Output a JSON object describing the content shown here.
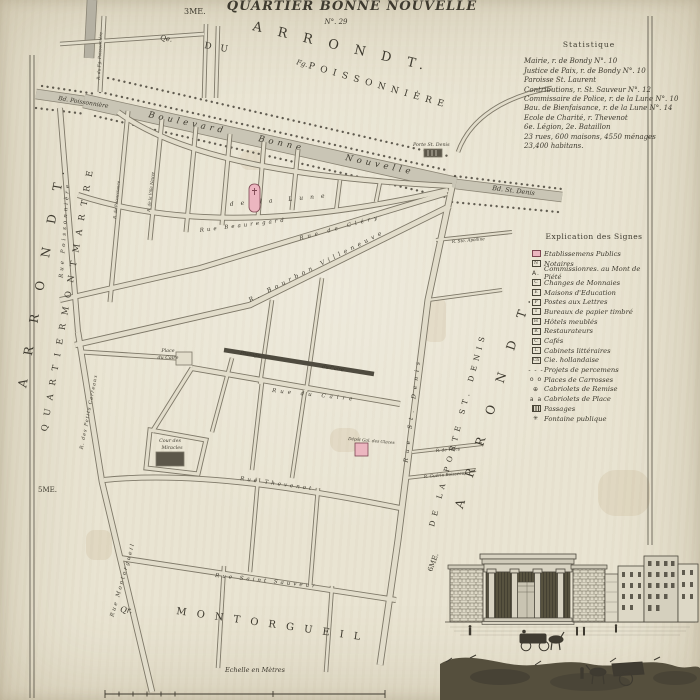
{
  "palette": {
    "paper": "#e9e4d2",
    "ink": "#3e3a2f",
    "street_edge": "#7e7868",
    "street_fill": "#e2ddcb",
    "band_fill": "#c9c5b5",
    "band_edge": "#8a8474",
    "dark_band": "#4f4b3f",
    "pink": "#ecb6c0",
    "pink_edge": "#7c4550",
    "building_dark": "#5c574a"
  },
  "statistics": {
    "title": "Statistique",
    "lines": [
      "Mairie, r. de Bondy N°. 10",
      "Justice de Paix, r. de Bondy N°. 10",
      "Paroisse St. Laurent",
      "Contributions, r. St. Sauveur N°. 12",
      "Commissaire de Police, r. de la Lune N°. 10",
      "Bau. de Bienfaisance, r. de la Lune N°. 14",
      "Ecole de Charité, r. Thevenot",
      "6e. Légion, 2e. Bataillon",
      "23 rues, 600 maisons, 4550 ménages",
      "23,400 habitans."
    ]
  },
  "legend": {
    "title": "Explication des Signes",
    "items": [
      {
        "kind": "pink",
        "sym": "",
        "label": "Etablissemens Publics"
      },
      {
        "kind": "box",
        "sym": "N",
        "label": "Notaires"
      },
      {
        "kind": "plain",
        "sym": "A.",
        "label": "Commissionres. au Mont de Piété"
      },
      {
        "kind": "box",
        "sym": "C",
        "label": "Changes de Monnaies"
      },
      {
        "kind": "box",
        "sym": "E",
        "label": "Maisons d'Education"
      },
      {
        "kind": "box",
        "sym": "P",
        "label": "Postes aux Lettres"
      },
      {
        "kind": "box",
        "sym": "T",
        "label": "Bureaux de papier timbré"
      },
      {
        "kind": "box",
        "sym": "H",
        "label": "Hôtels meublés"
      },
      {
        "kind": "box",
        "sym": "R",
        "label": "Restaurateurs"
      },
      {
        "kind": "box",
        "sym": "C",
        "label": "Cafés"
      },
      {
        "kind": "box",
        "sym": "L",
        "label": "Cabinets littéraires"
      },
      {
        "kind": "box",
        "sym": "Ch",
        "label": "Cie. hollandaise"
      },
      {
        "kind": "dash",
        "sym": "- - -",
        "label": "Projets de percemens"
      },
      {
        "kind": "plain",
        "sym": "o o",
        "label": "Places de Carrosses"
      },
      {
        "kind": "plain",
        "sym": "⊕",
        "label": "Cabriolets de Remise"
      },
      {
        "kind": "plain",
        "sym": "a a",
        "label": "Cabriolets de Place"
      },
      {
        "kind": "hatch",
        "sym": "",
        "label": "Passages"
      },
      {
        "kind": "plain",
        "sym": "✳",
        "label": "Fontaine publique"
      }
    ]
  },
  "map": {
    "neatlines": [
      "M30,55 L30,698",
      "M34,55 L34,698",
      "M648,16 L648,545",
      "M652,16 L652,545"
    ],
    "bands": [
      {
        "d": "M84,101 L456,184",
        "w": 13
      },
      {
        "d": "M456,184 L562,197",
        "w": 9
      },
      {
        "d": "M36,94 L84,101",
        "w": 9
      },
      {
        "d": "M92,0 L89,58",
        "w": 9,
        "f": "#b5b1a3"
      }
    ],
    "dark_bands": [
      {
        "d": "M224,350 L374,374",
        "w": 4.5
      }
    ],
    "dots": [
      "M108,78 L448,156",
      "M100,92 L446,170",
      "M95,116 L450,198",
      "M455,176 L562,189",
      "M452,202 L558,212",
      "M42,86 L96,94",
      "M36,108 L86,114"
    ],
    "streets": [
      {
        "d": "M118,112 C190,165 330,180 452,186",
        "w": 6
      },
      {
        "d": "M78,195 C200,235 340,215 448,190",
        "w": 6
      },
      {
        "d": "M60,300 L200,268 L447,193",
        "w": 6
      },
      {
        "d": "M75,345 L250,305 L450,206",
        "w": 6.5
      },
      {
        "d": "M452,187 L428,300 L398,540 L380,665",
        "w": 7
      },
      {
        "d": "M60,108 L78,332",
        "w": 6
      },
      {
        "d": "M78,332 L102,482 L152,692",
        "w": 6.5
      },
      {
        "d": "M104,480 C200,470 320,492 400,508",
        "w": 6
      },
      {
        "d": "M120,558 L396,600",
        "w": 6
      },
      {
        "d": "M192,368 L400,404",
        "w": 6
      },
      {
        "d": "M128,111 L110,302",
        "w": 5
      },
      {
        "d": "M162,119 L150,240",
        "w": 5
      },
      {
        "d": "M196,127 L186,232",
        "w": 5
      },
      {
        "d": "M230,134 L222,225",
        "w": 5
      },
      {
        "d": "M264,142 L258,218",
        "w": 5
      },
      {
        "d": "M298,149 L292,210",
        "w": 5
      },
      {
        "d": "M340,180 L336,212",
        "w": 4.5
      },
      {
        "d": "M380,182 L376,202",
        "w": 4.5
      },
      {
        "d": "M82,352 L176,358",
        "w": 5
      },
      {
        "d": "M232,358 L212,432",
        "w": 4.5
      },
      {
        "d": "M192,368 L152,432",
        "w": 5
      },
      {
        "d": "M150,430 L206,440 L198,474 L146,468 Z",
        "w": 5
      },
      {
        "d": "M322,278 L306,392",
        "w": 4.5
      },
      {
        "d": "M272,300 L260,384",
        "w": 4.5
      },
      {
        "d": "M262,382 L252,470",
        "w": 4.5
      },
      {
        "d": "M305,390 L292,478",
        "w": 4.5
      },
      {
        "d": "M258,478 L250,572",
        "w": 4.5
      },
      {
        "d": "M318,488 L310,588",
        "w": 4.5
      },
      {
        "d": "M224,566 L218,668",
        "w": 4.5
      },
      {
        "d": "M332,586 L326,672",
        "w": 4.5
      },
      {
        "d": "M412,452 L482,444",
        "w": 4
      },
      {
        "d": "M406,478 L476,470",
        "w": 4
      },
      {
        "d": "M436,240 L512,232",
        "w": 4
      },
      {
        "d": "M428,300 L502,290",
        "w": 4
      },
      {
        "d": "M104,16 L100,92",
        "w": 5
      },
      {
        "d": "M206,24 L204,98",
        "w": 4.5
      },
      {
        "d": "M218,26 L216,98",
        "w": 4.5
      },
      {
        "d": "M60,44 L204,34",
        "w": 4.5
      },
      {
        "d": "M552,88 C505,96 470,118 458,152",
        "w": 4.5
      }
    ],
    "buildings": [
      {
        "x": 249,
        "y": 184,
        "w": 11,
        "h": 28,
        "rx": 5,
        "f": "pink"
      },
      {
        "x": 355,
        "y": 443,
        "w": 13,
        "h": 13,
        "rx": 0,
        "f": "pink"
      },
      {
        "x": 424,
        "y": 149,
        "w": 18,
        "h": 8,
        "rx": 0,
        "f": "dark"
      },
      {
        "x": 176,
        "y": 352,
        "w": 16,
        "h": 13,
        "rx": 0,
        "f": "light"
      },
      {
        "x": 156,
        "y": 452,
        "w": 28,
        "h": 14,
        "rx": 0,
        "f": "dark"
      }
    ],
    "smudges": [
      {
        "x": 424,
        "y": 298,
        "w": 22,
        "h": 44
      },
      {
        "x": 86,
        "y": 530,
        "w": 26,
        "h": 30
      },
      {
        "x": 330,
        "y": 428,
        "w": 30,
        "h": 24
      },
      {
        "x": 598,
        "y": 470,
        "w": 52,
        "h": 46
      },
      {
        "x": 240,
        "y": 150,
        "w": 26,
        "h": 20
      }
    ],
    "labels": [
      {
        "t": "QUARTIER BONNE NOUVELLE",
        "x": 352,
        "y": 10,
        "r": 0,
        "s": 13,
        "ls": 1,
        "i": 1,
        "b": 1,
        "a": "middle"
      },
      {
        "t": "N°. 29",
        "x": 336,
        "y": 24,
        "r": 0,
        "s": 7,
        "i": 1,
        "a": "middle"
      },
      {
        "t": "3ME.",
        "x": 184,
        "y": 14,
        "r": 0,
        "s": 8
      },
      {
        "t": "A R R O N D T.",
        "x": 252,
        "y": 30,
        "r": 13,
        "s": 13,
        "ls": 6
      },
      {
        "t": "Qe.",
        "x": 160,
        "y": 40,
        "r": 8,
        "s": 7,
        "i": 1
      },
      {
        "t": "D U",
        "x": 204,
        "y": 48,
        "r": 10,
        "s": 9,
        "ls": 3
      },
      {
        "t": "Fg.",
        "x": 296,
        "y": 64,
        "r": 16,
        "s": 7,
        "i": 1
      },
      {
        "t": "P O I S S O N N I È R E",
        "x": 308,
        "y": 68,
        "r": 16,
        "s": 9,
        "ls": 1.5
      },
      {
        "t": "Bd. Poissonnière",
        "x": 58,
        "y": 100,
        "r": 9,
        "s": 6,
        "i": 1
      },
      {
        "t": "Boulevard",
        "x": 148,
        "y": 117,
        "r": 12,
        "s": 8.5,
        "ls": 4,
        "i": 1
      },
      {
        "t": "Bonne",
        "x": 258,
        "y": 141,
        "r": 12,
        "s": 8.5,
        "ls": 4,
        "i": 1
      },
      {
        "t": "Nouvelle",
        "x": 345,
        "y": 160,
        "r": 12,
        "s": 8.5,
        "ls": 4,
        "i": 1
      },
      {
        "t": "Porte St. Denis",
        "x": 413,
        "y": 146,
        "r": 0,
        "s": 4.8,
        "i": 1
      },
      {
        "t": "Bd. St. Denis",
        "x": 492,
        "y": 190,
        "r": 7,
        "s": 6.5,
        "i": 1
      },
      {
        "t": "A R R O N D T.",
        "x": 46,
        "y": 275,
        "r": -80,
        "s": 12,
        "ls": 10,
        "a": "middle"
      },
      {
        "t": "Q U A R T I E R   M O N T M A R T R E",
        "x": 70,
        "y": 300,
        "r": -80,
        "s": 8.5,
        "ls": 3,
        "a": "middle"
      },
      {
        "t": "5ME.",
        "x": 38,
        "y": 492,
        "r": 0,
        "s": 7
      },
      {
        "t": "A R R O N D T.",
        "x": 498,
        "y": 400,
        "r": -72,
        "s": 12,
        "ls": 10,
        "a": "middle"
      },
      {
        "t": "DE LA PORTE ST. DENIS",
        "x": 460,
        "y": 430,
        "r": -75,
        "s": 7.5,
        "ls": 5,
        "a": "middle"
      },
      {
        "t": "6ME.",
        "x": 432,
        "y": 572,
        "r": -70,
        "s": 7
      },
      {
        "t": "Qr.",
        "x": 120,
        "y": 612,
        "r": 6,
        "s": 8,
        "i": 1
      },
      {
        "t": "M O N T O R G U E I L",
        "x": 176,
        "y": 614,
        "r": 8,
        "s": 10,
        "ls": 3.5
      },
      {
        "t": "de la Lune",
        "x": 230,
        "y": 206,
        "r": -5,
        "s": 6,
        "ls": 7,
        "i": 1
      },
      {
        "t": "Rue Beauregard",
        "x": 200,
        "y": 232,
        "r": -7,
        "s": 5.5,
        "ls": 3,
        "i": 1
      },
      {
        "t": "Rue de Cléry",
        "x": 300,
        "y": 240,
        "r": -15,
        "s": 5.5,
        "ls": 4,
        "i": 1
      },
      {
        "t": "R. Bourbon Villeneuve",
        "x": 250,
        "y": 302,
        "r": -27,
        "s": 6,
        "ls": 4,
        "i": 1
      },
      {
        "t": "Rue Poissonnière",
        "x": 66,
        "y": 230,
        "r": -86,
        "s": 5.5,
        "ls": 3,
        "i": 1,
        "a": "middle"
      },
      {
        "t": "R. des Petits Carreaux",
        "x": 90,
        "y": 412,
        "r": -79,
        "s": 4.8,
        "ls": 1,
        "i": 1,
        "a": "middle"
      },
      {
        "t": "Rue Montorgueil",
        "x": 124,
        "y": 580,
        "r": -74,
        "s": 5.5,
        "ls": 2,
        "i": 1,
        "a": "middle"
      },
      {
        "t": "Rue St. Denis",
        "x": 414,
        "y": 410,
        "r": -83,
        "s": 6,
        "ls": 5,
        "i": 1,
        "a": "middle"
      },
      {
        "t": "Rue du Caire",
        "x": 272,
        "y": 392,
        "r": 6,
        "s": 5.5,
        "ls": 4,
        "i": 1
      },
      {
        "t": "Passage",
        "x": 240,
        "y": 354,
        "r": 9,
        "s": 5,
        "i": 1
      },
      {
        "t": "du Caire",
        "x": 322,
        "y": 368,
        "r": 9,
        "s": 5,
        "i": 1
      },
      {
        "t": "Place",
        "x": 168,
        "y": 352,
        "r": 0,
        "s": 4.8,
        "i": 1,
        "a": "middle"
      },
      {
        "t": "du Caire",
        "x": 168,
        "y": 359,
        "r": 0,
        "s": 4.8,
        "i": 1,
        "a": "middle"
      },
      {
        "t": "Cour des",
        "x": 170,
        "y": 442,
        "r": 0,
        "s": 4.8,
        "i": 1,
        "a": "middle"
      },
      {
        "t": "Miracles",
        "x": 172,
        "y": 449,
        "r": 0,
        "s": 4.8,
        "i": 1,
        "a": "middle"
      },
      {
        "t": "Dépôt Gal. des Glaces",
        "x": 348,
        "y": 440,
        "r": 5,
        "s": 4.2,
        "i": 1
      },
      {
        "t": "Rue Thevenot",
        "x": 240,
        "y": 480,
        "r": 8,
        "s": 5.5,
        "ls": 3,
        "i": 1
      },
      {
        "t": "Rue Saint Sauveur",
        "x": 215,
        "y": 577,
        "r": 6,
        "s": 5.5,
        "ls": 3,
        "i": 1
      },
      {
        "t": "R. Ste. Apolline",
        "x": 452,
        "y": 243,
        "r": -5,
        "s": 4.2,
        "i": 1
      },
      {
        "t": "R. de Tracy",
        "x": 436,
        "y": 452,
        "r": -5,
        "s": 4.2,
        "i": 1
      },
      {
        "t": "R. Guérin Boisseau",
        "x": 424,
        "y": 478,
        "r": -5,
        "s": 4.2,
        "i": 1
      },
      {
        "t": "R. du Fg. Poissonnière",
        "x": 101,
        "y": 56,
        "r": -87,
        "s": 4.2,
        "i": 1,
        "a": "middle"
      },
      {
        "t": "R. de Recouvrance",
        "x": 118,
        "y": 200,
        "r": -84,
        "s": 4,
        "i": 1,
        "a": "middle"
      },
      {
        "t": "R. de la Ville Neuve",
        "x": 152,
        "y": 192,
        "r": -84,
        "s": 4,
        "i": 1,
        "a": "middle"
      },
      {
        "t": "Echelle en Mètres",
        "x": 255,
        "y": 672,
        "r": 0,
        "s": 6.5,
        "i": 1,
        "a": "middle"
      }
    ],
    "scalebar": {
      "x1": 105,
      "x2": 385,
      "y": 694,
      "mid": 273,
      "minor_step": 14,
      "minor_count": 5
    }
  }
}
